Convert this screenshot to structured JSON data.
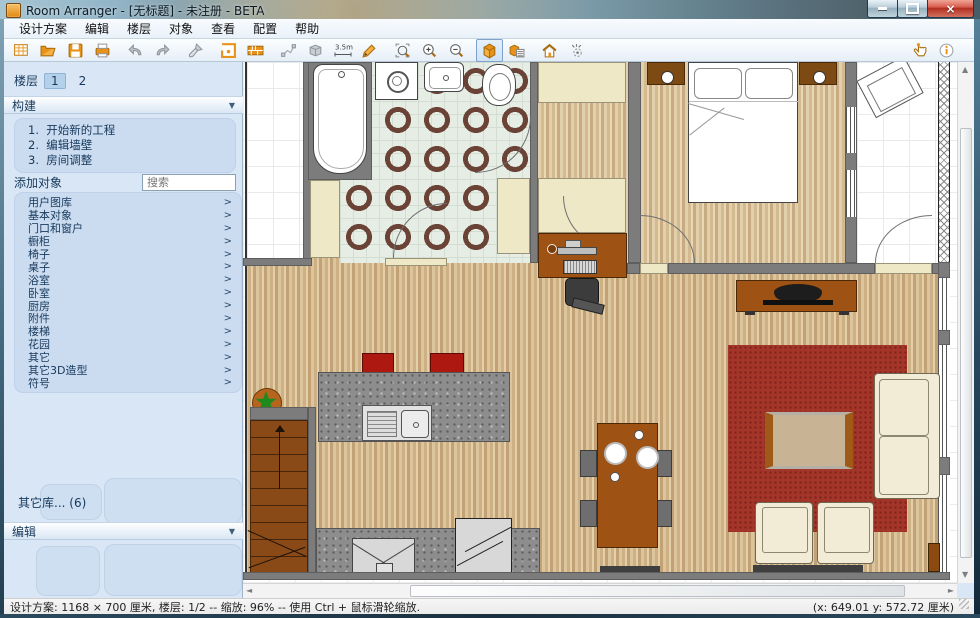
{
  "window": {
    "title": "Room Arranger - [无标题] - 未注册 - BETA"
  },
  "menu": {
    "items": [
      "设计方案",
      "编辑",
      "楼层",
      "对象",
      "查看",
      "配置",
      "帮助"
    ]
  },
  "toolbar": {
    "buttons": [
      "new-project",
      "open",
      "save",
      "print",
      "undo",
      "redo",
      "format-brush",
      "room-plan",
      "wall",
      "polyline",
      "move-3d",
      "measure",
      "draw",
      "zoom-selection",
      "zoom-in",
      "zoom-out",
      "view-3d",
      "view-3d-objects",
      "home-3d",
      "walk-mode"
    ],
    "right_buttons": [
      "pointer",
      "info"
    ],
    "selected": "view-3d",
    "measure_label": "3.5m"
  },
  "sidebar": {
    "floors": {
      "label": "楼层",
      "buttons": [
        "1",
        "2"
      ],
      "active": "1"
    },
    "build": {
      "header": "构建",
      "steps": [
        "1.  开始新的工程",
        "2.  编辑墙壁",
        "3.  房间调整"
      ]
    },
    "add_objects": {
      "header": "添加对象",
      "search_placeholder": "搜索",
      "categories": [
        "用户图库",
        "基本对象",
        "门口和窗户",
        "橱柜",
        "椅子",
        "桌子",
        "浴室",
        "卧室",
        "厨房",
        "附件",
        "楼梯",
        "花园",
        "其它",
        "其它3D造型",
        "符号"
      ]
    },
    "other_libs": "其它库...  (6)",
    "edit": {
      "header": "编辑"
    }
  },
  "statusbar": {
    "left": "设计方案: 1168 × 700 厘米, 楼层: 1/2 -- 缩放: 96% -- 使用 Ctrl + 鼠标滑轮缩放.",
    "right": "(x: 649.01 y: 572.72 厘米)"
  },
  "icons": {
    "chevron_right": ">",
    "dropdown": "▼",
    "close": "×",
    "up": "▲",
    "down": "▼",
    "left": "◄",
    "right": "►"
  },
  "colors": {
    "accent_orange": "#e8921a",
    "selection_blue": "#7da2ce",
    "wall_gray": "#7c7c7c",
    "rug_red": "#a33529",
    "sidebar_blue": "#d9e6f5"
  }
}
